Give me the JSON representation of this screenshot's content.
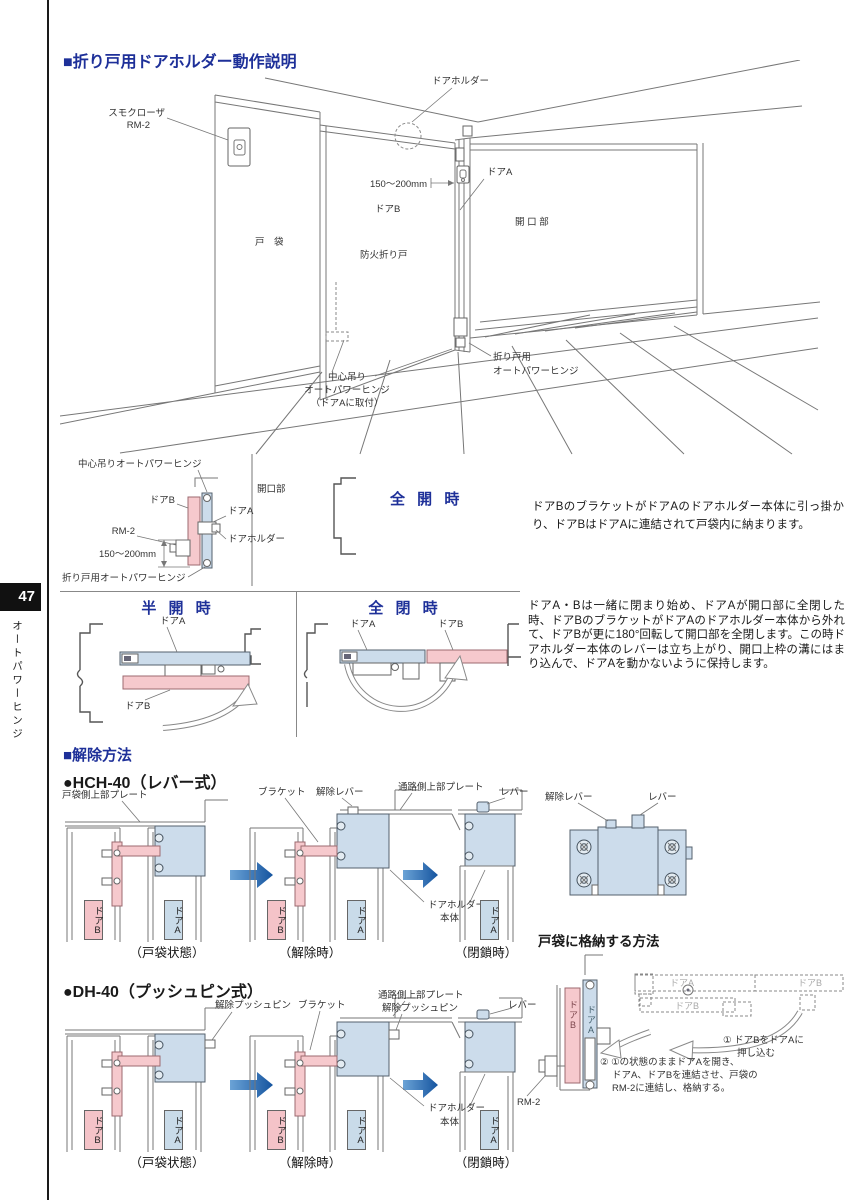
{
  "page": {
    "number": "47",
    "sidebar": "オートパワーヒンジ",
    "accent": "#1e3099",
    "pink": "#f6c9cd",
    "lightblue": "#ccdceb",
    "arrow_blue": "#15549f"
  },
  "sec1": {
    "title": "■折り戸用ドアホルダー動作説明",
    "persp": {
      "door_holder": "ドアホルダー",
      "smoke_closer_1": "スモクローザ",
      "smoke_closer_2": "RM-2",
      "dim": "150〜200mm",
      "door_a": "ドアA",
      "door_b": "ドアB",
      "opening": "開 口 部",
      "pocket": "戸　袋",
      "fire_door": "防火折り戸",
      "center_hinge_1": "中心吊り",
      "center_hinge_2": "オートパワーヒンジ",
      "center_hinge_3": "（ドアAに取付）",
      "fold_hinge_1": "折り戸用",
      "fold_hinge_2": "オートパワーヒンジ"
    }
  },
  "fullopen": {
    "title": "全 開 時",
    "labels": {
      "center_hinge": "中心吊りオートパワーヒンジ",
      "door_b": "ドアB",
      "opening": "開口部",
      "door_a": "ドアA",
      "rm2": "RM-2",
      "door_holder": "ドアホルダー",
      "dim": "150〜200mm",
      "fold_hinge": "折り戸用オートパワーヒンジ"
    },
    "para": "ドアBのブラケットがドアAのドアホルダー本体に引っ掛かり、ドアBはドアAに連結されて戸袋内に納まります。"
  },
  "halfopen": {
    "title": "半 開 時",
    "door_a": "ドアA",
    "door_b": "ドアB"
  },
  "fullclose": {
    "title": "全 閉 時",
    "door_a": "ドアA",
    "door_b": "ドアB",
    "para": "ドアA・Bは一緒に閉まり始め、ドアAが開口部に全閉した時、ドアBのブラケットがドアAのドアホルダー本体から外れて、ドアBが更に180°回転して開口部を全閉します。この時ドアホルダー本体のレバーは立ち上がり、開口上枠の溝にはまり込んで、ドアAを動かないように保持します。"
  },
  "release": {
    "header": "■解除方法",
    "door_a": "ドアA",
    "door_b": "ドアB",
    "hch40": {
      "title": "●HCH-40（レバー式）",
      "plate_pocket": "戸袋側上部プレート",
      "bracket": "ブラケット",
      "release_lever": "解除レバー",
      "plate_passage": "通路側上部プレート",
      "lever": "レバー",
      "holder_1": "ドアホルダー",
      "holder_2": "本体",
      "cap1": "（戸袋状態）",
      "cap2": "（解除時）",
      "cap3": "（閉鎖時）"
    },
    "dh40": {
      "title": "●DH-40（プッシュピン式）",
      "release_pin": "解除プッシュピン",
      "bracket": "ブラケット",
      "plate_passage": "通路側上部プレート",
      "release_pin2": "解除プッシュピン",
      "lever": "レバー",
      "holder_1": "ドアホルダー",
      "holder_2": "本体",
      "cap1": "（戸袋状態）",
      "cap2": "（解除時）",
      "cap3": "（閉鎖時）"
    },
    "detail": {
      "release_lever": "解除レバー",
      "lever": "レバー"
    }
  },
  "storage": {
    "title": "戸袋に格納する方法",
    "door_a": "ドアA",
    "door_b": "ドアB",
    "ghost_a": "ドアA",
    "ghost_b": "ドアB",
    "ghost_b2": "ドアB",
    "rm2": "RM-2",
    "step1_1": "① ドアBをドアAに",
    "step1_2": "押し込む",
    "step2_1": "② ①の状態のままドアAを開き、",
    "step2_2": "ドアA、ドアBを連結させ、戸袋の",
    "step2_3": "RM-2に連結し、格納する。"
  }
}
